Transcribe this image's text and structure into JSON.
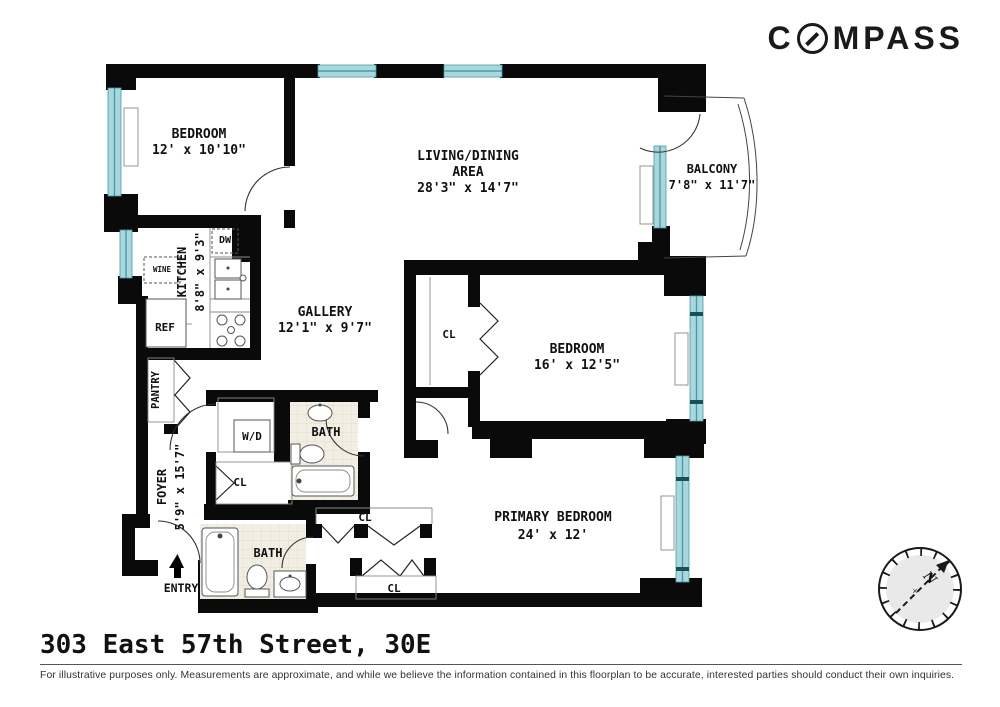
{
  "brand": {
    "name": "COMPASS",
    "logo_prefix": "C",
    "logo_suffix": "MPASS"
  },
  "footer": {
    "title": "303 East 57th Street, 30E",
    "disclaimer": "For illustrative purposes only.  Measurements are approximate, and while we believe the information contained in this floorplan to be accurate, interested parties should conduct their own inquiries."
  },
  "compass_rose": {
    "north": "N",
    "center_mark": "×"
  },
  "colors": {
    "wall": "#0a0a0a",
    "window": "#a8d8de",
    "window_frame": "#4b9aa6",
    "tile": "#f2eee3"
  },
  "plan": {
    "rooms": {
      "bedroom1": {
        "label": "BEDROOM",
        "dims": "12' x 10'10\""
      },
      "living": {
        "label1": "LIVING/DINING",
        "label2": "AREA",
        "dims": "28'3\" x 14'7\""
      },
      "balcony": {
        "label": "BALCONY",
        "dims": "7'8\" x 11'7\""
      },
      "kitchen": {
        "label": "KITCHEN",
        "dims": "8'8\" x 9'3\""
      },
      "gallery": {
        "label": "GALLERY",
        "dims": "12'1\" x 9'7\""
      },
      "bedroom2": {
        "label": "BEDROOM",
        "dims": "16' x 12'5\""
      },
      "primary_bedroom": {
        "label": "PRIMARY BEDROOM",
        "dims": "24' x 12'"
      },
      "foyer": {
        "label": "FOYER",
        "dims": "5'9\" x 15'7\""
      }
    },
    "features": {
      "pantry": "PANTRY",
      "entry": "ENTRY",
      "wd": "W/D",
      "bath_upper": "BATH",
      "bath_lower": "BATH",
      "closet_bedroom2": "CL",
      "closet_foyer": "CL",
      "closet_primary_top": "CL",
      "closet_primary_bottom": "CL",
      "dishwasher": "DW",
      "wine": "WINE",
      "fridge": "REF"
    }
  }
}
